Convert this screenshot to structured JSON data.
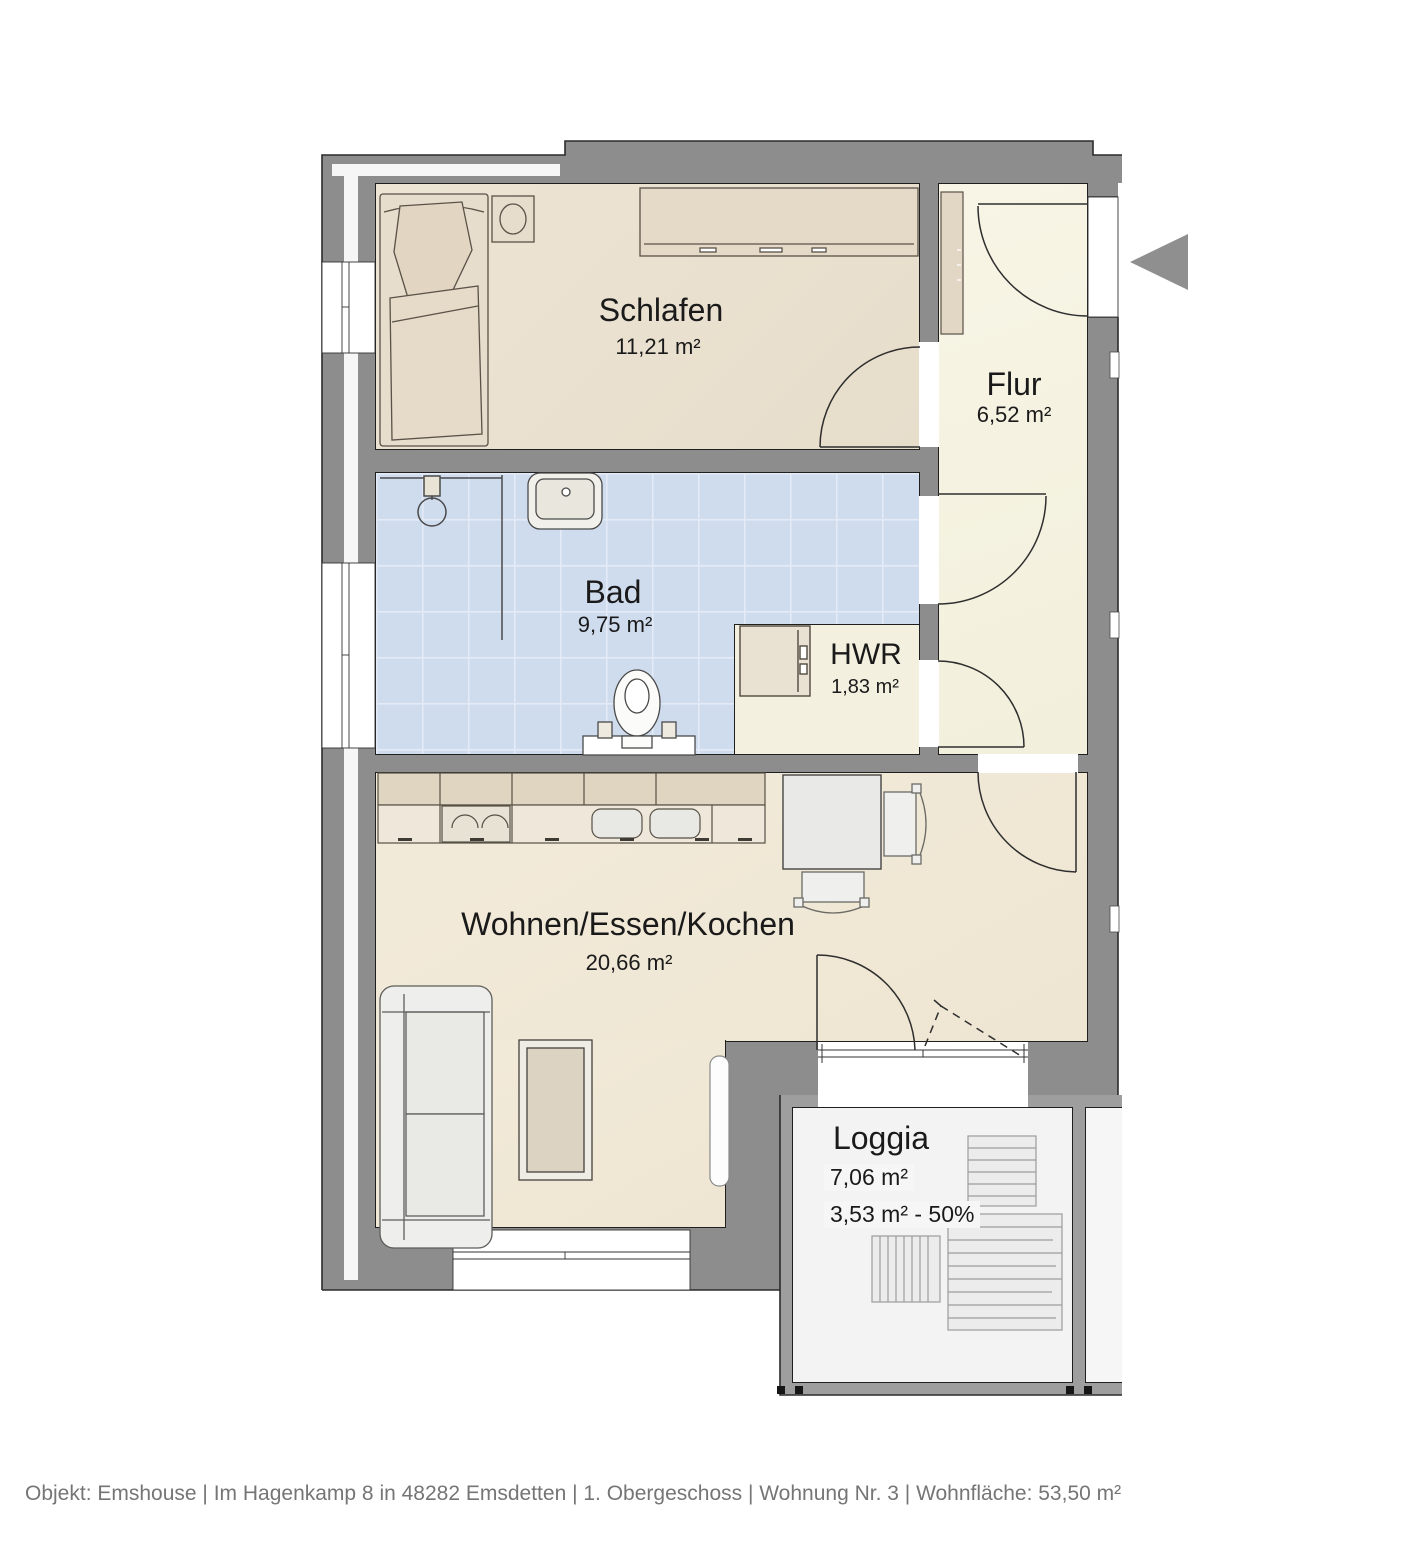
{
  "rooms": [
    {
      "name": "Schlafen",
      "area": "11,21 m²"
    },
    {
      "name": "Flur",
      "area": "6,52 m²"
    },
    {
      "name": "Bad",
      "area": "9,75 m²"
    },
    {
      "name": "HWR",
      "area": "1,83 m²"
    },
    {
      "name": "Wohnen/Essen/Kochen",
      "area": "20,66 m²"
    },
    {
      "name": "Loggia",
      "area": "7,06 m²",
      "area_half": "3,53 m² - 50%"
    }
  ],
  "footer": "Objekt: Emshouse | Im Hagenkamp 8 in 48282 Emsdetten | 1. Obergeschoss | Wohnung Nr. 3 | Wohnfläche: 53,50 m²",
  "colors": {
    "wall": "#8d8d8d",
    "loggia_wall": "#9e9e9e",
    "bath_tile": "#cfdcee",
    "warm_floor": "#ece3d3",
    "arrow": "#8f8f8f",
    "text": "#1a1a1a",
    "footer_text": "#757575"
  }
}
